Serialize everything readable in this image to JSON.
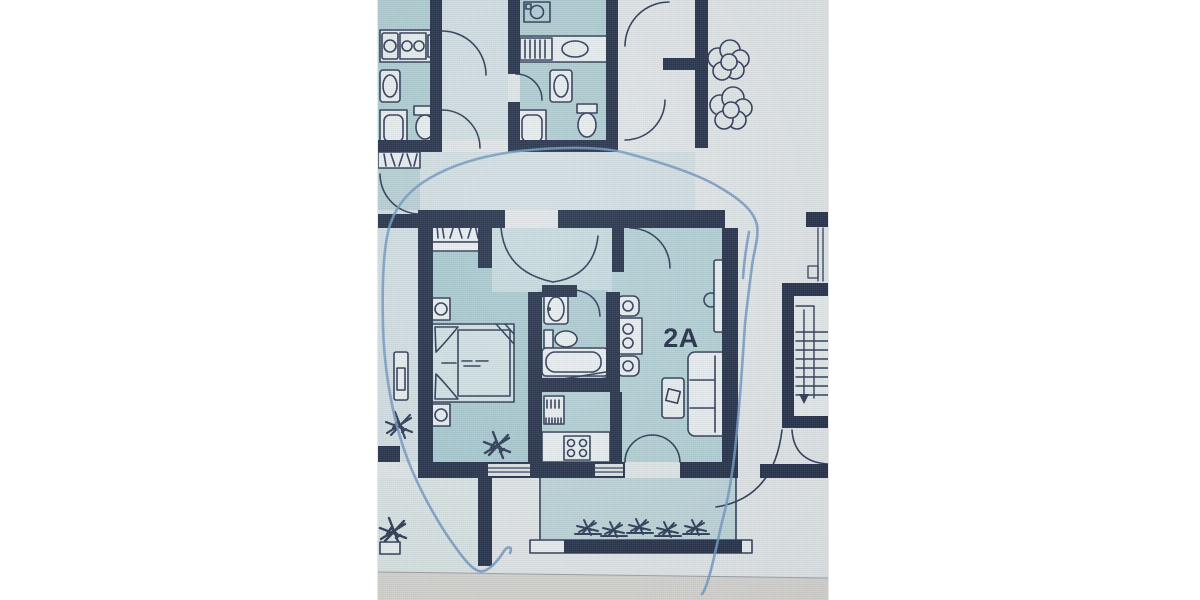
{
  "floorplan": {
    "unit_label": "2A",
    "stair_arrow_direction": "down",
    "colors": {
      "paper": "#e2e6e7",
      "wall": "#212d45",
      "fixture_stroke": "#2a3752",
      "fixture_fill": "#e9eeef",
      "bedroom_fill": "#a8c9cf",
      "living_fill": "#b3d0d5",
      "hall_fill": "#c7dade",
      "bathroom_fill": "#adccd2",
      "top_bathroom_fill": "#b0cdd2",
      "left_room_fill": "#b7d0d4",
      "corridor_fill": "#d3dfe2",
      "balcony_fill": "#bed5d8",
      "lower_room_fill": "#dbe4e3",
      "bed_fill": "#d2e1e3",
      "page_edge_band": "#d6d4cf",
      "pen_annotation": "#7096c0",
      "label": "#1c2940"
    }
  }
}
